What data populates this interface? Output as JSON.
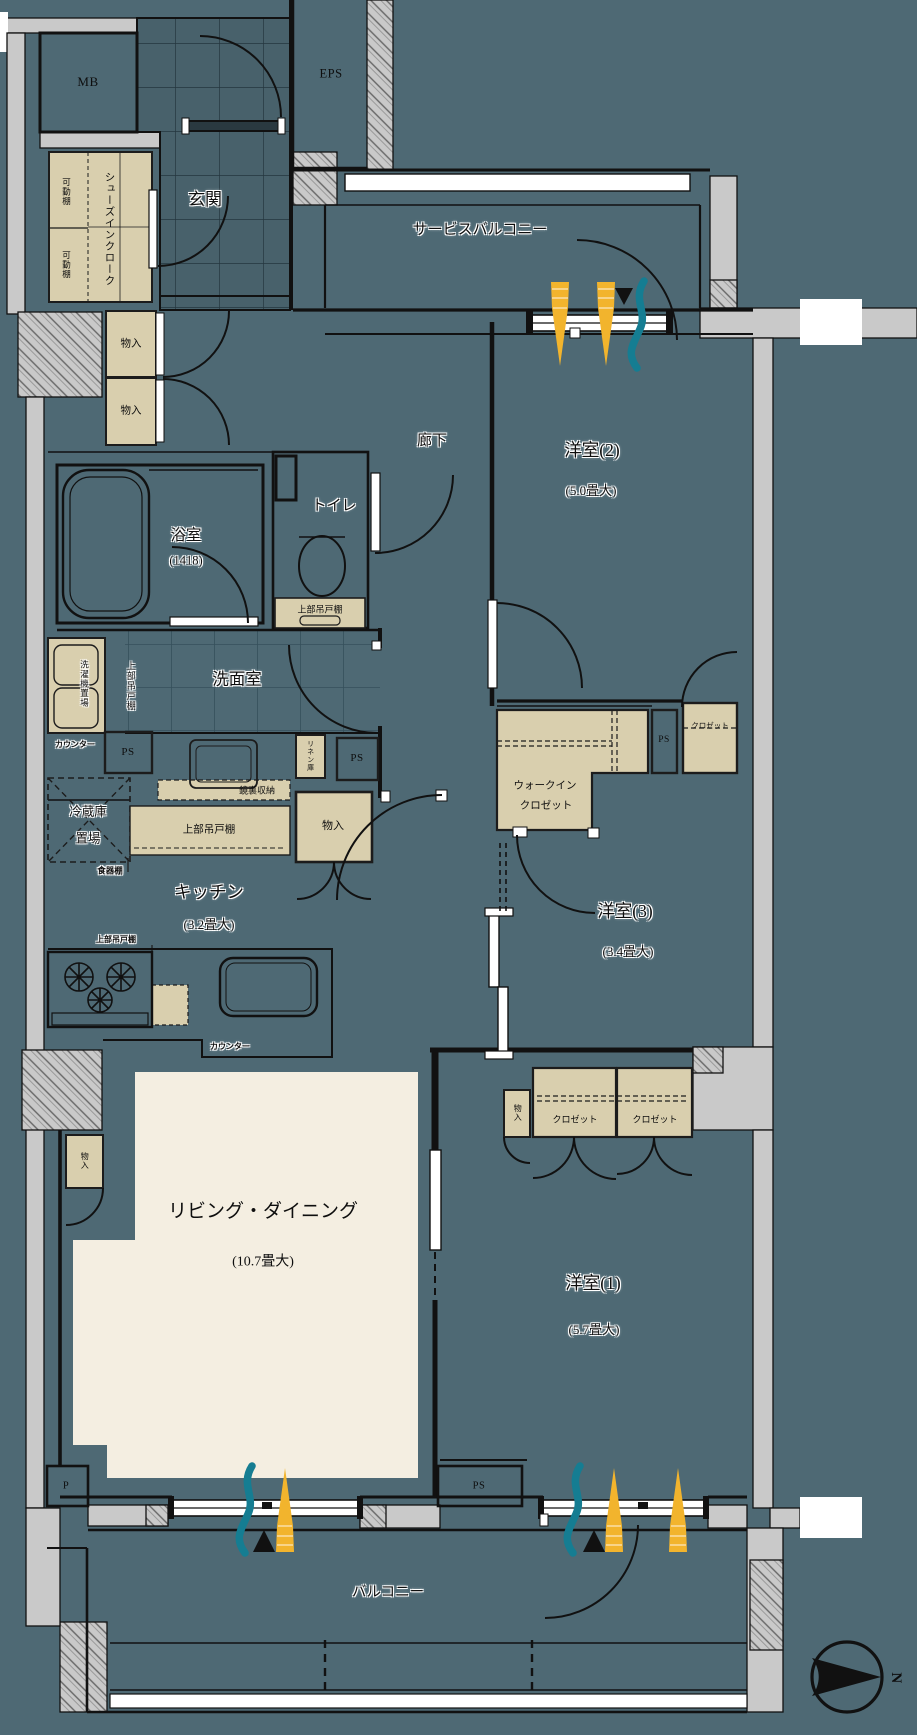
{
  "meta": {
    "title": "間取り図",
    "type": "floorplan"
  },
  "colors": {
    "floor_teal": "#4e6974",
    "wall_gray": "#c9c9c9",
    "storage_beige": "#d9cfae",
    "flooring_cream": "#f4eee1",
    "sunlight_yellow": "#f2b42d",
    "airflow_teal": "#157d92",
    "line_black": "#111111"
  },
  "rooms": {
    "genkan": {
      "label": "玄関"
    },
    "service_balcony": {
      "label": "サービスバルコニー"
    },
    "corridor": {
      "label": "廊下"
    },
    "western2": {
      "label": "洋室(2)",
      "size": "(5.0畳大)"
    },
    "western3": {
      "label": "洋室(3)",
      "size": "(3.4畳大)"
    },
    "western1": {
      "label": "洋室(1)",
      "size": "(5.7畳大)"
    },
    "living_dining": {
      "label": "リビング・ダイニング",
      "size": "(10.7畳大)"
    },
    "kitchen": {
      "label": "キッチン",
      "size": "(3.2畳大)"
    },
    "bathroom": {
      "label": "浴室",
      "size": "(1418)"
    },
    "toilet": {
      "label": "トイレ"
    },
    "washroom": {
      "label": "洗面室"
    },
    "balcony": {
      "label": "バルコニー"
    },
    "walk_in_closet": {
      "line1": "ウォークイン",
      "line2": "クロゼット"
    }
  },
  "fixtures": {
    "mb": "MB",
    "eps": "EPS",
    "ps": "PS",
    "p": "P",
    "shoes_cloak_line1": "シューズイン",
    "shoes_cloak_line2": "クローク",
    "movable_shelf": "可動棚",
    "storage": "物入",
    "upper_cabinet": "上部吊戸棚",
    "counter": "カウンター",
    "mirror_storage": "鏡裏収納",
    "linen": "リネン庫",
    "fridge_line1": "冷蔵庫",
    "fridge_line2": "置場",
    "dish_shelf": "食器棚",
    "washer": "洗濯機置場",
    "closet": "クロゼット"
  },
  "compass": {
    "north": "N"
  }
}
